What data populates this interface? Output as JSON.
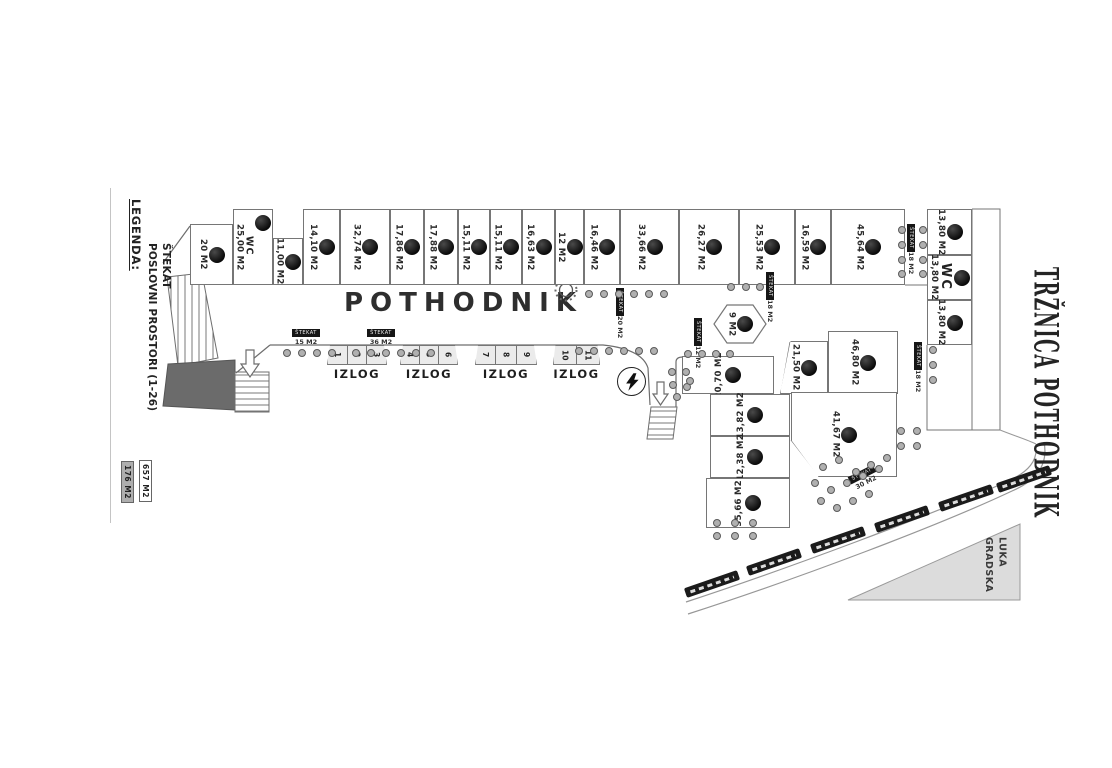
{
  "titles": {
    "plan": "POTHODNIK",
    "side": "TRŽNICA POTHODNIK",
    "port_line1": "GRADSKA",
    "port_line2": "LUKA"
  },
  "legend": {
    "heading": "LEGENDA:",
    "item1": "POSLOVNI PROSTORI (1-26)",
    "item2": "ŠTEKAT",
    "area1": "657 M2",
    "area2": "176 M2"
  },
  "stall_caption": "IZLOG",
  "stekat_word": "ŠTEKAT",
  "colors": {
    "line": "#777777",
    "dark_fill": "#6b6b6b",
    "triangle_fill": "#dcdcdc",
    "marker": "#111111"
  },
  "units": [
    {
      "label": "20 M2",
      "x": 190,
      "y": 224,
      "w": 43,
      "h": 61
    },
    {
      "label": "25,00 M2",
      "wc": "WC",
      "x": 233,
      "y": 209,
      "w": 40,
      "h": 76,
      "circleTop": true
    },
    {
      "label": "11,00 M2",
      "x": 273,
      "y": 238,
      "w": 30,
      "h": 47
    },
    {
      "label": "14,10 M2",
      "x": 303,
      "y": 209,
      "w": 37,
      "h": 76
    },
    {
      "label": "32,74 M2",
      "x": 340,
      "y": 209,
      "w": 50,
      "h": 76
    },
    {
      "label": "17,86 M2",
      "x": 390,
      "y": 209,
      "w": 34,
      "h": 76
    },
    {
      "label": "17,88 M2",
      "x": 424,
      "y": 209,
      "w": 34,
      "h": 76
    },
    {
      "label": "15,11 M2",
      "x": 458,
      "y": 209,
      "w": 32,
      "h": 76
    },
    {
      "label": "15,11 M2",
      "x": 490,
      "y": 209,
      "w": 32,
      "h": 76
    },
    {
      "label": "16,63 M2",
      "x": 522,
      "y": 209,
      "w": 33,
      "h": 76
    },
    {
      "label": "12 M2",
      "x": 555,
      "y": 209,
      "w": 29,
      "h": 76
    },
    {
      "label": "16,46 M2",
      "x": 584,
      "y": 209,
      "w": 36,
      "h": 76
    },
    {
      "label": "33,66 M2",
      "x": 620,
      "y": 209,
      "w": 59,
      "h": 76
    },
    {
      "label": "26,27 M2",
      "x": 679,
      "y": 209,
      "w": 60,
      "h": 76
    },
    {
      "label": "25,53 M2",
      "x": 739,
      "y": 209,
      "w": 56,
      "h": 76
    },
    {
      "label": "16,59 M2",
      "x": 795,
      "y": 209,
      "w": 36,
      "h": 76
    },
    {
      "label": "45,64 M2",
      "x": 831,
      "y": 209,
      "w": 74,
      "h": 76
    },
    {
      "label": "13,80 M2",
      "x": 927,
      "y": 209,
      "w": 45,
      "h": 46
    },
    {
      "label": "13,80 M2",
      "wc": "WC",
      "wcBig": true,
      "x": 927,
      "y": 255,
      "w": 45,
      "h": 45
    },
    {
      "label": "13,80 M2",
      "x": 927,
      "y": 300,
      "w": 45,
      "h": 45
    },
    {
      "label": "20,70 M2",
      "x": 682,
      "y": 356,
      "w": 92,
      "h": 38,
      "orient": "ccw"
    },
    {
      "label": "13,82 M2",
      "x": 710,
      "y": 394,
      "w": 80,
      "h": 42,
      "orient": "ccw"
    },
    {
      "label": "12,38 M2",
      "x": 710,
      "y": 436,
      "w": 80,
      "h": 42,
      "orient": "ccw"
    },
    {
      "label": "35,66 M2",
      "x": 706,
      "y": 478,
      "w": 84,
      "h": 50,
      "orient": "ccw"
    },
    {
      "label": "21,50 M2",
      "x": 780,
      "y": 341,
      "w": 48,
      "h": 53,
      "kind": "u-slant-l"
    },
    {
      "label": "46,80 M2",
      "x": 828,
      "y": 331,
      "w": 70,
      "h": 63
    },
    {
      "label": "41,67 M2",
      "x": 791,
      "y": 392,
      "w": 106,
      "h": 85,
      "kind": "u-slant-bl"
    },
    {
      "label": "9 M2",
      "x": 714,
      "y": 305,
      "w": 52,
      "h": 38,
      "kind": "u-hex"
    }
  ],
  "stall_groups": [
    {
      "x": 327,
      "w": 60,
      "numbers": [
        "1",
        "2",
        "3"
      ]
    },
    {
      "x": 400,
      "w": 58,
      "numbers": [
        "4",
        "5",
        "6"
      ]
    },
    {
      "x": 475,
      "w": 62,
      "numbers": [
        "7",
        "8",
        "9"
      ]
    },
    {
      "x": 553,
      "w": 47,
      "numbers": [
        "10",
        "11"
      ]
    }
  ],
  "stekat_labels": [
    {
      "x": 288,
      "y": 329,
      "area": "15 M2",
      "dir": "h"
    },
    {
      "x": 363,
      "y": 329,
      "area": "36 M2",
      "dir": "h"
    },
    {
      "x": 612,
      "y": 288,
      "area": "20 M2",
      "dir": "v"
    },
    {
      "x": 690,
      "y": 318,
      "area": "12 M2",
      "dir": "v"
    },
    {
      "x": 762,
      "y": 272,
      "area": "18 M2",
      "dir": "v"
    },
    {
      "x": 903,
      "y": 224,
      "area": "18 M2",
      "dir": "v"
    },
    {
      "x": 910,
      "y": 342,
      "area": "18 M2",
      "dir": "v"
    },
    {
      "x": 846,
      "y": 470,
      "area": "30 M2",
      "dir": "r"
    }
  ],
  "dots": [
    [
      585,
      290
    ],
    [
      600,
      290
    ],
    [
      615,
      290
    ],
    [
      630,
      290
    ],
    [
      645,
      290
    ],
    [
      660,
      290
    ],
    [
      283,
      349
    ],
    [
      298,
      349
    ],
    [
      313,
      349
    ],
    [
      328,
      349
    ],
    [
      352,
      349
    ],
    [
      367,
      349
    ],
    [
      382,
      349
    ],
    [
      397,
      349
    ],
    [
      412,
      349
    ],
    [
      427,
      349
    ],
    [
      575,
      347
    ],
    [
      590,
      347
    ],
    [
      605,
      347
    ],
    [
      620,
      347
    ],
    [
      635,
      347
    ],
    [
      650,
      347
    ],
    [
      727,
      283
    ],
    [
      742,
      283
    ],
    [
      756,
      283
    ],
    [
      668,
      368
    ],
    [
      682,
      368
    ],
    [
      669,
      381
    ],
    [
      683,
      383
    ],
    [
      673,
      393
    ],
    [
      686,
      377
    ],
    [
      684,
      350
    ],
    [
      698,
      350
    ],
    [
      712,
      350
    ],
    [
      726,
      350
    ],
    [
      898,
      226
    ],
    [
      919,
      226
    ],
    [
      898,
      241
    ],
    [
      919,
      241
    ],
    [
      898,
      256
    ],
    [
      919,
      256
    ],
    [
      898,
      270
    ],
    [
      919,
      270
    ],
    [
      929,
      346
    ],
    [
      929,
      361
    ],
    [
      929,
      376
    ],
    [
      713,
      519
    ],
    [
      713,
      532
    ],
    [
      731,
      519
    ],
    [
      731,
      532
    ],
    [
      749,
      519
    ],
    [
      749,
      532
    ],
    [
      897,
      427
    ],
    [
      913,
      427
    ],
    [
      897,
      442
    ],
    [
      913,
      442
    ],
    [
      819,
      463
    ],
    [
      835,
      456
    ],
    [
      852,
      468
    ],
    [
      867,
      461
    ],
    [
      883,
      454
    ],
    [
      811,
      479
    ],
    [
      827,
      486
    ],
    [
      843,
      479
    ],
    [
      859,
      472
    ],
    [
      875,
      465
    ],
    [
      817,
      497
    ],
    [
      833,
      504
    ],
    [
      849,
      497
    ],
    [
      865,
      490
    ]
  ],
  "benches": [
    [
      712,
      584
    ],
    [
      774,
      562
    ],
    [
      838,
      540
    ],
    [
      902,
      519
    ],
    [
      966,
      498
    ],
    [
      1024,
      479
    ]
  ]
}
